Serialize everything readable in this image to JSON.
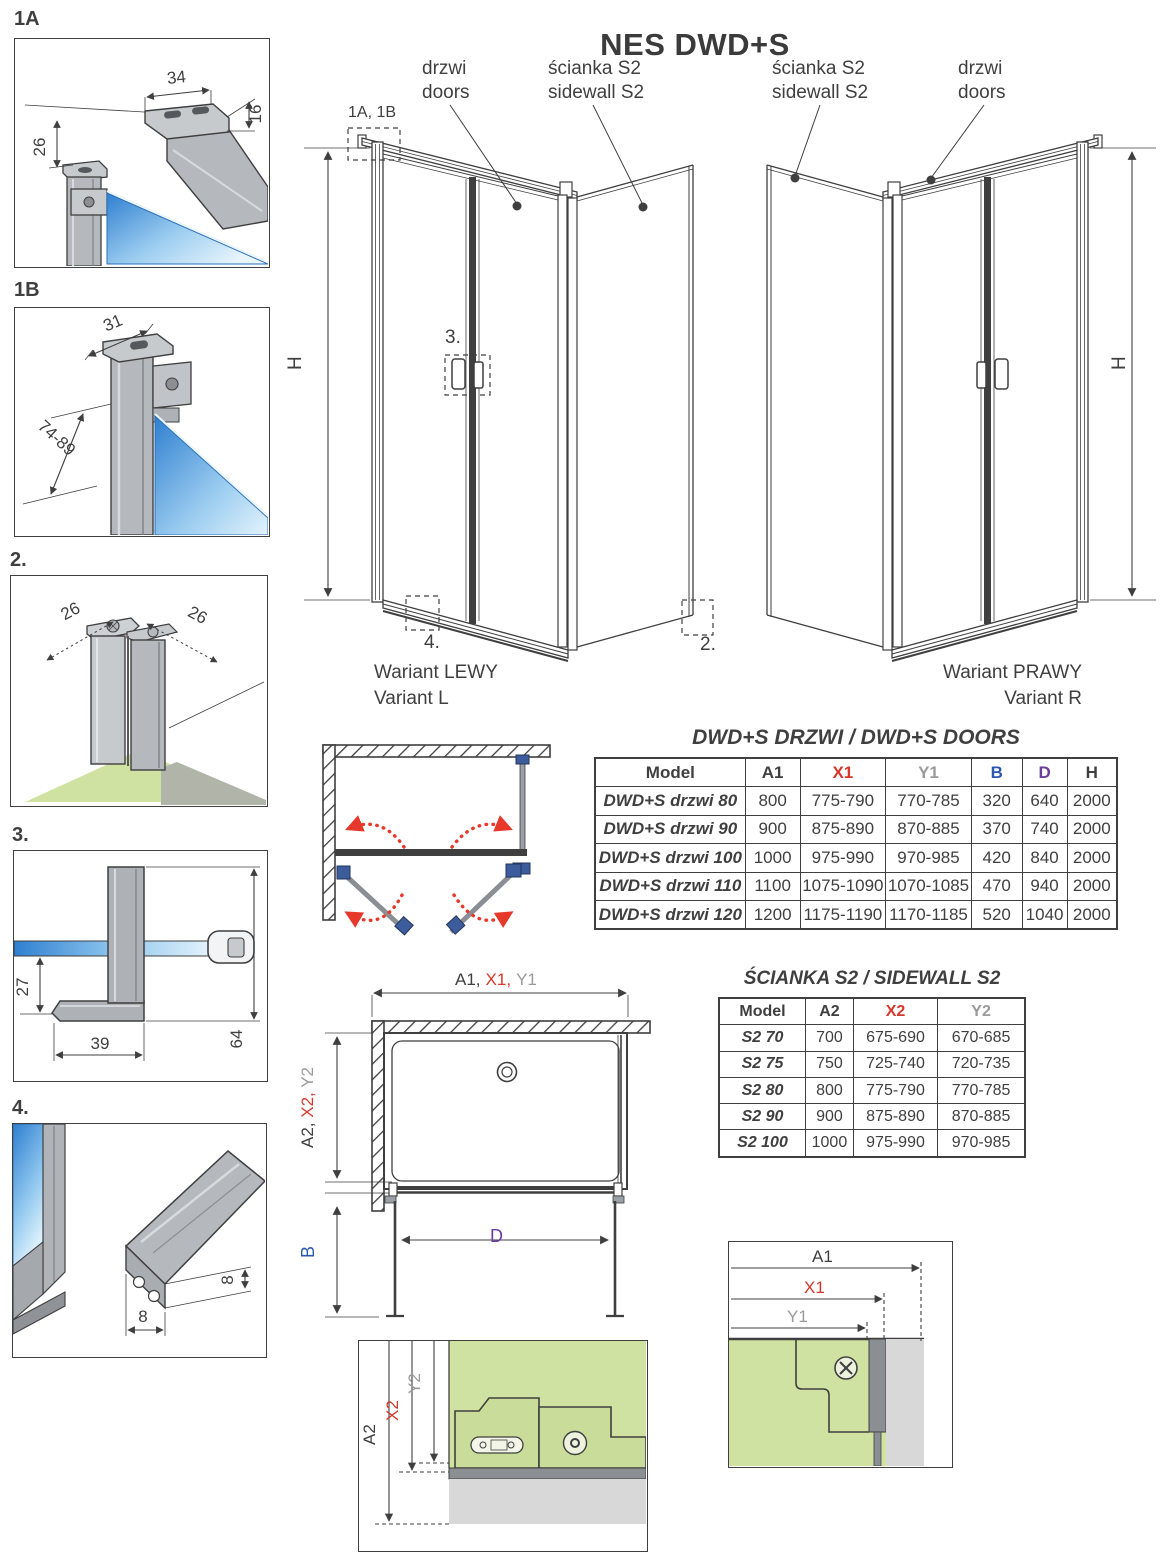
{
  "title": "NES DWD+S",
  "colors": {
    "ink": "#3f3f3f",
    "accent_red": "#d6372a",
    "dim_gray": "#9a9a9a",
    "dim_blue": "#2b58b0",
    "dim_purple": "#6a3d9e",
    "swing_arrow_red": "#e6392b",
    "glass_blue_dark": "#2f7fd0",
    "glass_blue_light": "#d9effc",
    "floor_green": "#d0e2a2",
    "profile_gray": "#b5b9bd"
  },
  "details": {
    "d1a": {
      "id": "1A",
      "dim_top": "34",
      "dim_side": "16",
      "dim_drop": "26"
    },
    "d1b": {
      "id": "1B",
      "dim_top": "31",
      "dim_range": "74-89"
    },
    "d2": {
      "id": "2.",
      "dim_left": "26",
      "dim_right": "26"
    },
    "d3": {
      "id": "3.",
      "dim_offset": "27",
      "dim_base": "39",
      "dim_height": "64"
    },
    "d4": {
      "id": "4.",
      "dim_height": "8",
      "dim_width": "8"
    }
  },
  "variant_left": {
    "door_label_pl": "drzwi",
    "door_label_en": "doors",
    "sidewall_label_pl": "ścianka S2",
    "sidewall_label_en": "sidewall S2",
    "height_label": "H",
    "ref_top": "1A, 1B",
    "ref_handle": "3.",
    "ref_sill": "4.",
    "ref_corner": "2.",
    "caption_pl": "Wariant LEWY",
    "caption_en": "Variant L"
  },
  "variant_right": {
    "sidewall_label_pl": "ścianka S2",
    "sidewall_label_en": "sidewall S2",
    "door_label_pl": "drzwi",
    "door_label_en": "doors",
    "height_label": "H",
    "caption_pl": "Wariant PRAWY",
    "caption_en": "Variant R"
  },
  "doors_table": {
    "title": "DWD+S DRZWI / DWD+S DOORS",
    "col_model": "Model",
    "col_a1": "A1",
    "col_x1": "X1",
    "col_y1": "Y1",
    "col_b": "B",
    "col_d": "D",
    "col_h": "H",
    "rows": [
      {
        "model": "DWD+S drzwi 80",
        "a1": "800",
        "x1": "775-790",
        "y1": "770-785",
        "b": "320",
        "d": "640",
        "h": "2000"
      },
      {
        "model": "DWD+S drzwi 90",
        "a1": "900",
        "x1": "875-890",
        "y1": "870-885",
        "b": "370",
        "d": "740",
        "h": "2000"
      },
      {
        "model": "DWD+S drzwi 100",
        "a1": "1000",
        "x1": "975-990",
        "y1": "970-985",
        "b": "420",
        "d": "840",
        "h": "2000"
      },
      {
        "model": "DWD+S drzwi 110",
        "a1": "1100",
        "x1": "1075-1090",
        "y1": "1070-1085",
        "b": "470",
        "d": "940",
        "h": "2000"
      },
      {
        "model": "DWD+S drzwi 120",
        "a1": "1200",
        "x1": "1175-1190",
        "y1": "1170-1185",
        "b": "520",
        "d": "1040",
        "h": "2000"
      }
    ]
  },
  "sidewall_table": {
    "title": "ŚCIANKA S2 / SIDEWALL S2",
    "col_model": "Model",
    "col_a2": "A2",
    "col_x2": "X2",
    "col_y2": "Y2",
    "rows": [
      {
        "model": "S2 70",
        "a2": "700",
        "x2": "675-690",
        "y2": "670-685"
      },
      {
        "model": "S2 75",
        "a2": "750",
        "x2": "725-740",
        "y2": "720-735"
      },
      {
        "model": "S2 80",
        "a2": "800",
        "x2": "775-790",
        "y2": "770-785"
      },
      {
        "model": "S2 90",
        "a2": "900",
        "x2": "875-890",
        "y2": "870-885"
      },
      {
        "model": "S2 100",
        "a2": "1000",
        "x2": "975-990",
        "y2": "970-985"
      }
    ]
  },
  "plan": {
    "dim_a1": "A1,",
    "dim_x1": "X1,",
    "dim_y1": "Y1",
    "dim_a2": "A2,",
    "dim_x2": "X2,",
    "dim_y2": "Y2",
    "dim_b": "B",
    "dim_d": "D"
  },
  "detail_mid": {
    "dim_a2": "A2",
    "dim_x2": "X2",
    "dim_y2": "Y2"
  },
  "detail_corner": {
    "dim_a1": "A1",
    "dim_x1": "X1",
    "dim_y1": "Y1"
  }
}
